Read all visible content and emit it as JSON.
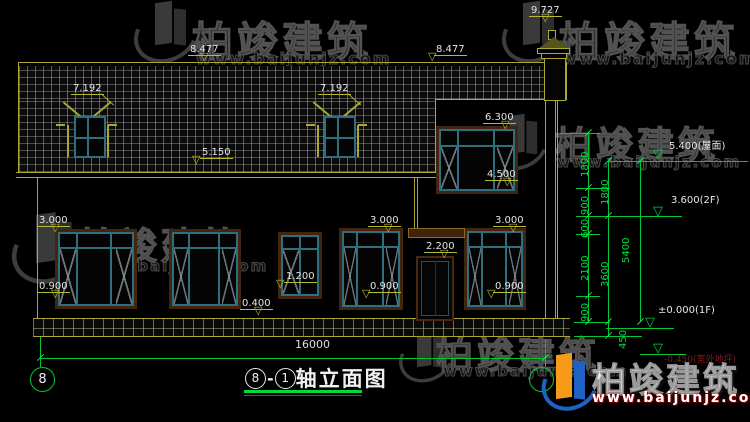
{
  "watermark": {
    "brand": "柏竣建筑",
    "url": "www.baijunjz.com"
  },
  "title": {
    "axis_left": "8",
    "dash": "-",
    "axis_right": "1",
    "text": "轴立面图"
  },
  "axis_bubble_left": "8",
  "bottom_dim": "16000",
  "elevations": {
    "chimney_top": "9.727",
    "ridge_left": "8.477",
    "ridge_right": "8.477",
    "dormer_left": "7.192",
    "dormer_right": "7.192",
    "eave_main": "5.150",
    "win2f_top": "6.300",
    "win2f_sill": "4.500",
    "win_left_top": "3.000",
    "win_left_sill": "0.900",
    "plinth_top": "0.400",
    "win_small_sill": "1.200",
    "door_top": "2.200",
    "win_mid_top": "3.000",
    "win_mid_sill": "0.900",
    "win_right_top": "3.000",
    "win_right_sill": "0.900"
  },
  "levels": {
    "roof": "5.400(屋面)",
    "floor2": "3.600(2F)",
    "floor1": "±0.000(1F)",
    "ground": "-0.450(室外地坪)"
  },
  "dims": {
    "chain1": [
      "1800",
      "900",
      "600",
      "2100",
      "900"
    ],
    "chain2": [
      "1800",
      "3600"
    ],
    "chain2_bottom": "450",
    "chain3": "5400"
  }
}
